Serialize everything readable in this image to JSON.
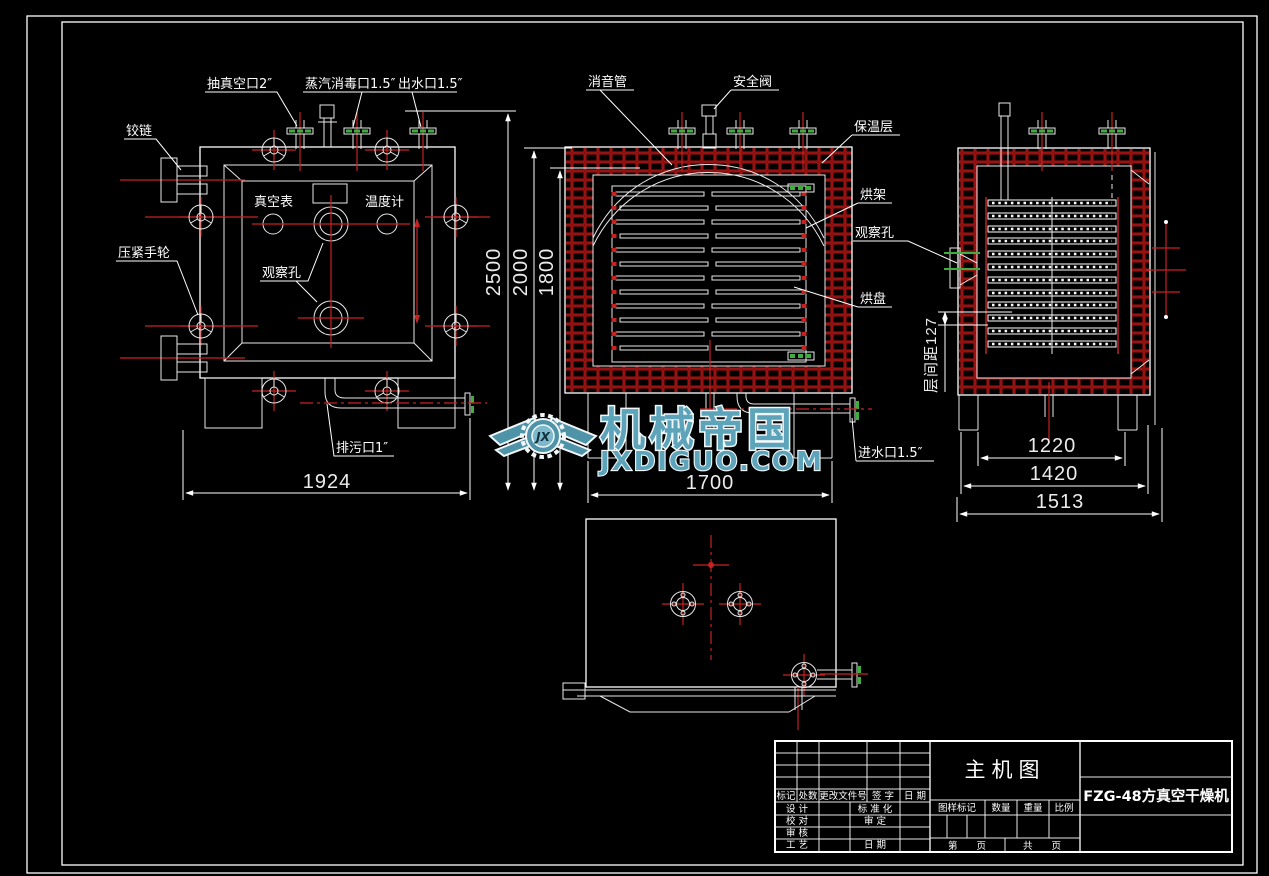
{
  "front_view": {
    "labels": {
      "vacuum_port": "抽真空口2″",
      "steam_port": "蒸汽消毒口1.5″",
      "water_outlet": "出水口1.5″",
      "hinge": "铰链",
      "clamp_handwheel": "压紧手轮",
      "vacuum_gauge": "真空表",
      "thermometer": "温度计",
      "observation_hole": "观察孔",
      "drain_port": "排污口1″"
    },
    "dims": {
      "overall_width": "1924"
    }
  },
  "section_view": {
    "labels": {
      "muffler": "消音管",
      "safety_valve": "安全阀",
      "insulation_layer": "保温层",
      "drying_rack": "烘架",
      "observation_hole": "观察孔",
      "drying_tray": "烘盘",
      "water_inlet": "进水口1.5″"
    },
    "dims": {
      "overall_height": "2500",
      "body_height": "2000",
      "chamber_height": "1800",
      "body_width": "1700"
    }
  },
  "side_view": {
    "dims": {
      "layer_spacing": "层间距127",
      "rack_width": "1220",
      "body_width": "1420",
      "overall_width": "1513"
    }
  },
  "title_block": {
    "drawing_title": "主机图",
    "part_name": "FZG-48方真空干燥机",
    "revision_headers": {
      "mark": "标记",
      "count": "处数",
      "change_doc_no": "更改文件号",
      "signature": "签 字",
      "date": "日 期"
    },
    "roles": {
      "design": "设 计",
      "standardization": "标 准 化",
      "proofread": "校 对",
      "approve": "审 定",
      "review": "审 核",
      "process": "工 艺",
      "date": "日 期"
    },
    "spec_headers": {
      "drawing_mark": "图样标记",
      "quantity": "数量",
      "weight": "重量",
      "scale": "比例"
    },
    "pages": {
      "sheet": "第　　页",
      "total": "共　　页"
    }
  },
  "watermark": {
    "brand": "机械帝国",
    "site": "JXDIGUO.COM",
    "monogram": "JX"
  },
  "colors": {
    "background": "#000000",
    "line": "#ffffff",
    "centerline_red": "#c62222",
    "hatch_red": "#a81414",
    "gasket_green": "#3fae3f",
    "watermark_teal": "#5da4bb"
  }
}
